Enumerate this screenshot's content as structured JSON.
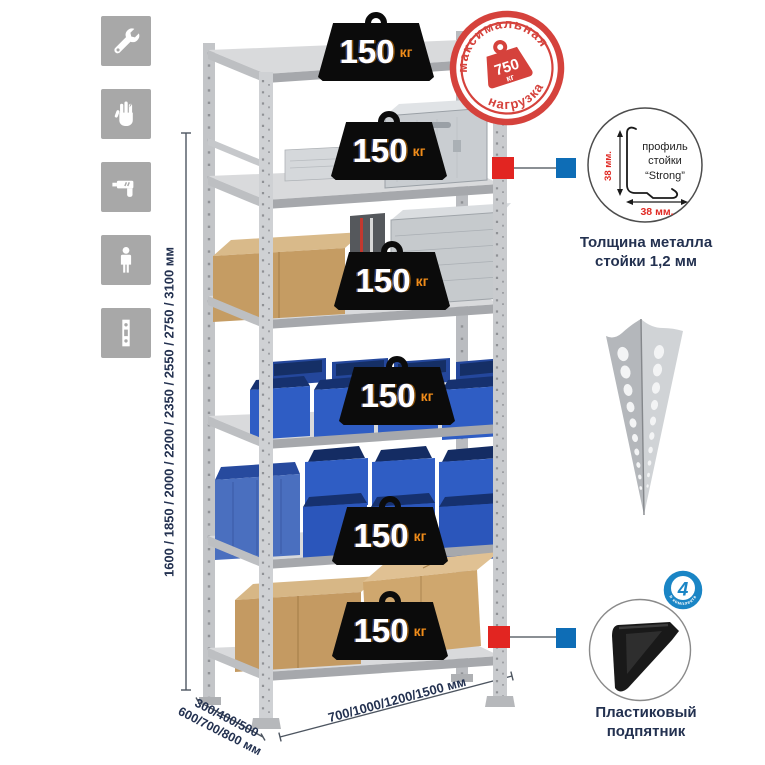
{
  "dimensions": {
    "height": "1600 / 1850 / 2000 / 2200 / 2350 / 2550 / 2750 / 3100 мм",
    "depth_line1": "300/400/500",
    "depth_line2": "600/700/800 мм",
    "width": "700/1000/1200/1500 мм"
  },
  "shelf_loads": [
    {
      "value": "150",
      "unit": "кг"
    },
    {
      "value": "150",
      "unit": "кг"
    },
    {
      "value": "150",
      "unit": "кг"
    },
    {
      "value": "150",
      "unit": "кг"
    },
    {
      "value": "150",
      "unit": "кг"
    },
    {
      "value": "150",
      "unit": "кг"
    }
  ],
  "max_load_stamp": {
    "arc_top": "максимальная",
    "arc_bottom": "нагрузка",
    "value": "750",
    "unit": "кг"
  },
  "profile_callout": {
    "line1": "профиль",
    "line2": "стойки",
    "line3": "“Strong”",
    "dim_v": "38 мм.",
    "dim_h": "38 мм.",
    "caption1": "Толщина металла",
    "caption2": "стойки 1,2 мм"
  },
  "foot_callout": {
    "badge_number": "4",
    "badge_arc": "в комплекте",
    "caption1": "Пластиковый",
    "caption2": "подпятник"
  },
  "icons": [
    "wrench-icon",
    "gloves-icon",
    "drill-icon",
    "person-icon",
    "rack-post-icon"
  ],
  "colors": {
    "stamp_red": "#d5423c",
    "marker_red": "#e22521",
    "marker_blue": "#0e6db6",
    "badge_blue": "#1a85c5",
    "weight_black": "#0b0b0b",
    "unit_orange": "#f08c1a",
    "bin_blue": "#2f5dc4",
    "icon_gray": "#a8a8a8",
    "caption_navy": "#233150"
  }
}
